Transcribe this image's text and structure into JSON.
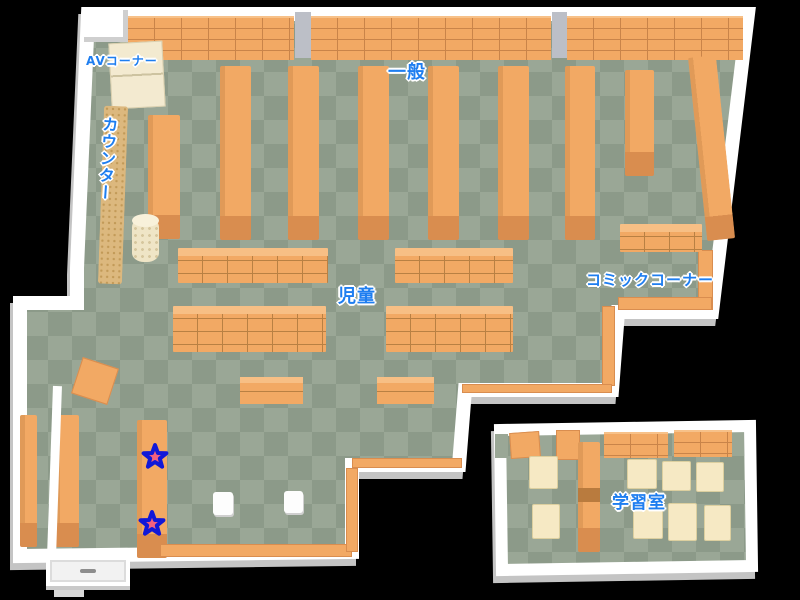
{
  "map": {
    "title_hint": "library-floor-map",
    "labels": {
      "av_corner": "AVコーナー",
      "general": "一般",
      "counter": "カウンター",
      "children": "児童",
      "comic_corner": "コミックコーナー",
      "study_room": "学習室"
    },
    "markers": {
      "star_count": 2,
      "star_positions": [
        {
          "x": 155,
          "y": 457
        },
        {
          "x": 152,
          "y": 524
        }
      ]
    },
    "colors": {
      "background": "#000000",
      "floor_light": "#9aa796",
      "floor_dark": "#8c9a89",
      "wall": "#ffffff",
      "wall_shadow": "#c4c4c4",
      "shelf": "#f2a964",
      "shelf_front": "#d98d4f",
      "table_cream": "#f6e9c4",
      "label_blue": "#1e7ef0",
      "star_fill": "#f4607e",
      "star_outline": "#1118d8"
    }
  }
}
